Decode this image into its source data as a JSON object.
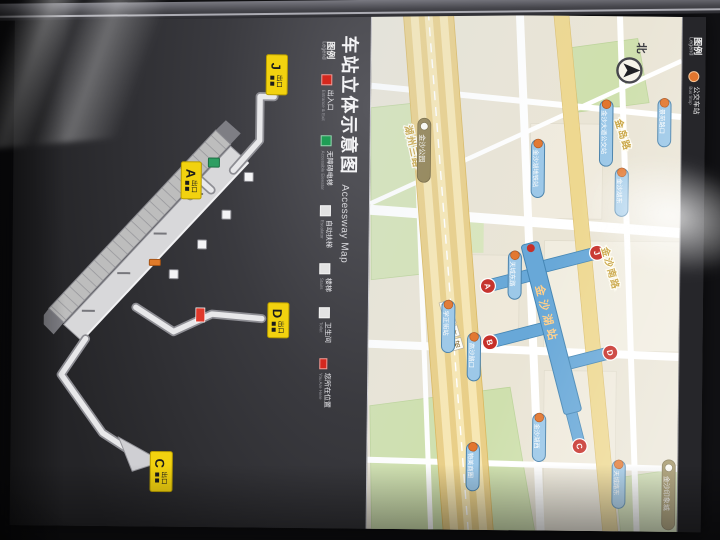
{
  "board": {
    "title": {
      "zh": "车站立体示意图",
      "en": "Accessway Map"
    },
    "map_legend": {
      "header_zh": "图例",
      "header_en": "Legend",
      "bus_zh": "公交车站",
      "bus_en": "Bus Stop"
    },
    "legend": {
      "header_zh": "图例",
      "header_en": "Legend",
      "items": [
        {
          "zh": "出入口",
          "en": "Entrance & Exit",
          "color": "#d5281e"
        },
        {
          "zh": "无障碍电梯",
          "en": "Accessible Elevator",
          "color": "#1f9d55"
        },
        {
          "zh": "自动扶梯",
          "en": "Escalator",
          "color": "#e2e2e2"
        },
        {
          "zh": "楼梯",
          "en": "Stairs",
          "color": "#e2e2e2"
        },
        {
          "zh": "卫生间",
          "en": "Toilet",
          "color": "#e2e2e2"
        },
        {
          "zh": "您所在位置",
          "en": "You Are Here",
          "color": "#d5281e"
        }
      ]
    },
    "compass_label": "北",
    "station_name": "金沙湖站",
    "roads": [
      "金岛路",
      "金沙南路",
      "湖州三路"
    ],
    "boxed_road": [
      "三",
      "环",
      "高",
      "架"
    ],
    "landmarks": [
      "金沙公园",
      "金沙印象城"
    ],
    "bus_stops": [
      "金沙湖地铁站",
      "金沙大道公交站",
      "景苑路口",
      "金沙湖东",
      "天城东路",
      "高沙路口",
      "学正街站",
      "金沙湖西",
      "物美商圈",
      "天城路东"
    ],
    "map_exits": [
      "A",
      "B",
      "C",
      "D",
      "J"
    ],
    "diagram_exits": [
      {
        "letter": "J",
        "zh": "出口"
      },
      {
        "letter": "A",
        "zh": "出口"
      },
      {
        "letter": "D",
        "zh": "出口"
      },
      {
        "letter": "C",
        "zh": "出口"
      }
    ],
    "colors": {
      "board_bg": "#39393d",
      "map_bg": "#eae5d6",
      "metro_blue": "#68a8d8",
      "exit_red": "#c62f28",
      "badge_yellow": "#f2d20f",
      "bus_pill": "#9cc8e8",
      "accent_orange": "#e2762e"
    }
  }
}
